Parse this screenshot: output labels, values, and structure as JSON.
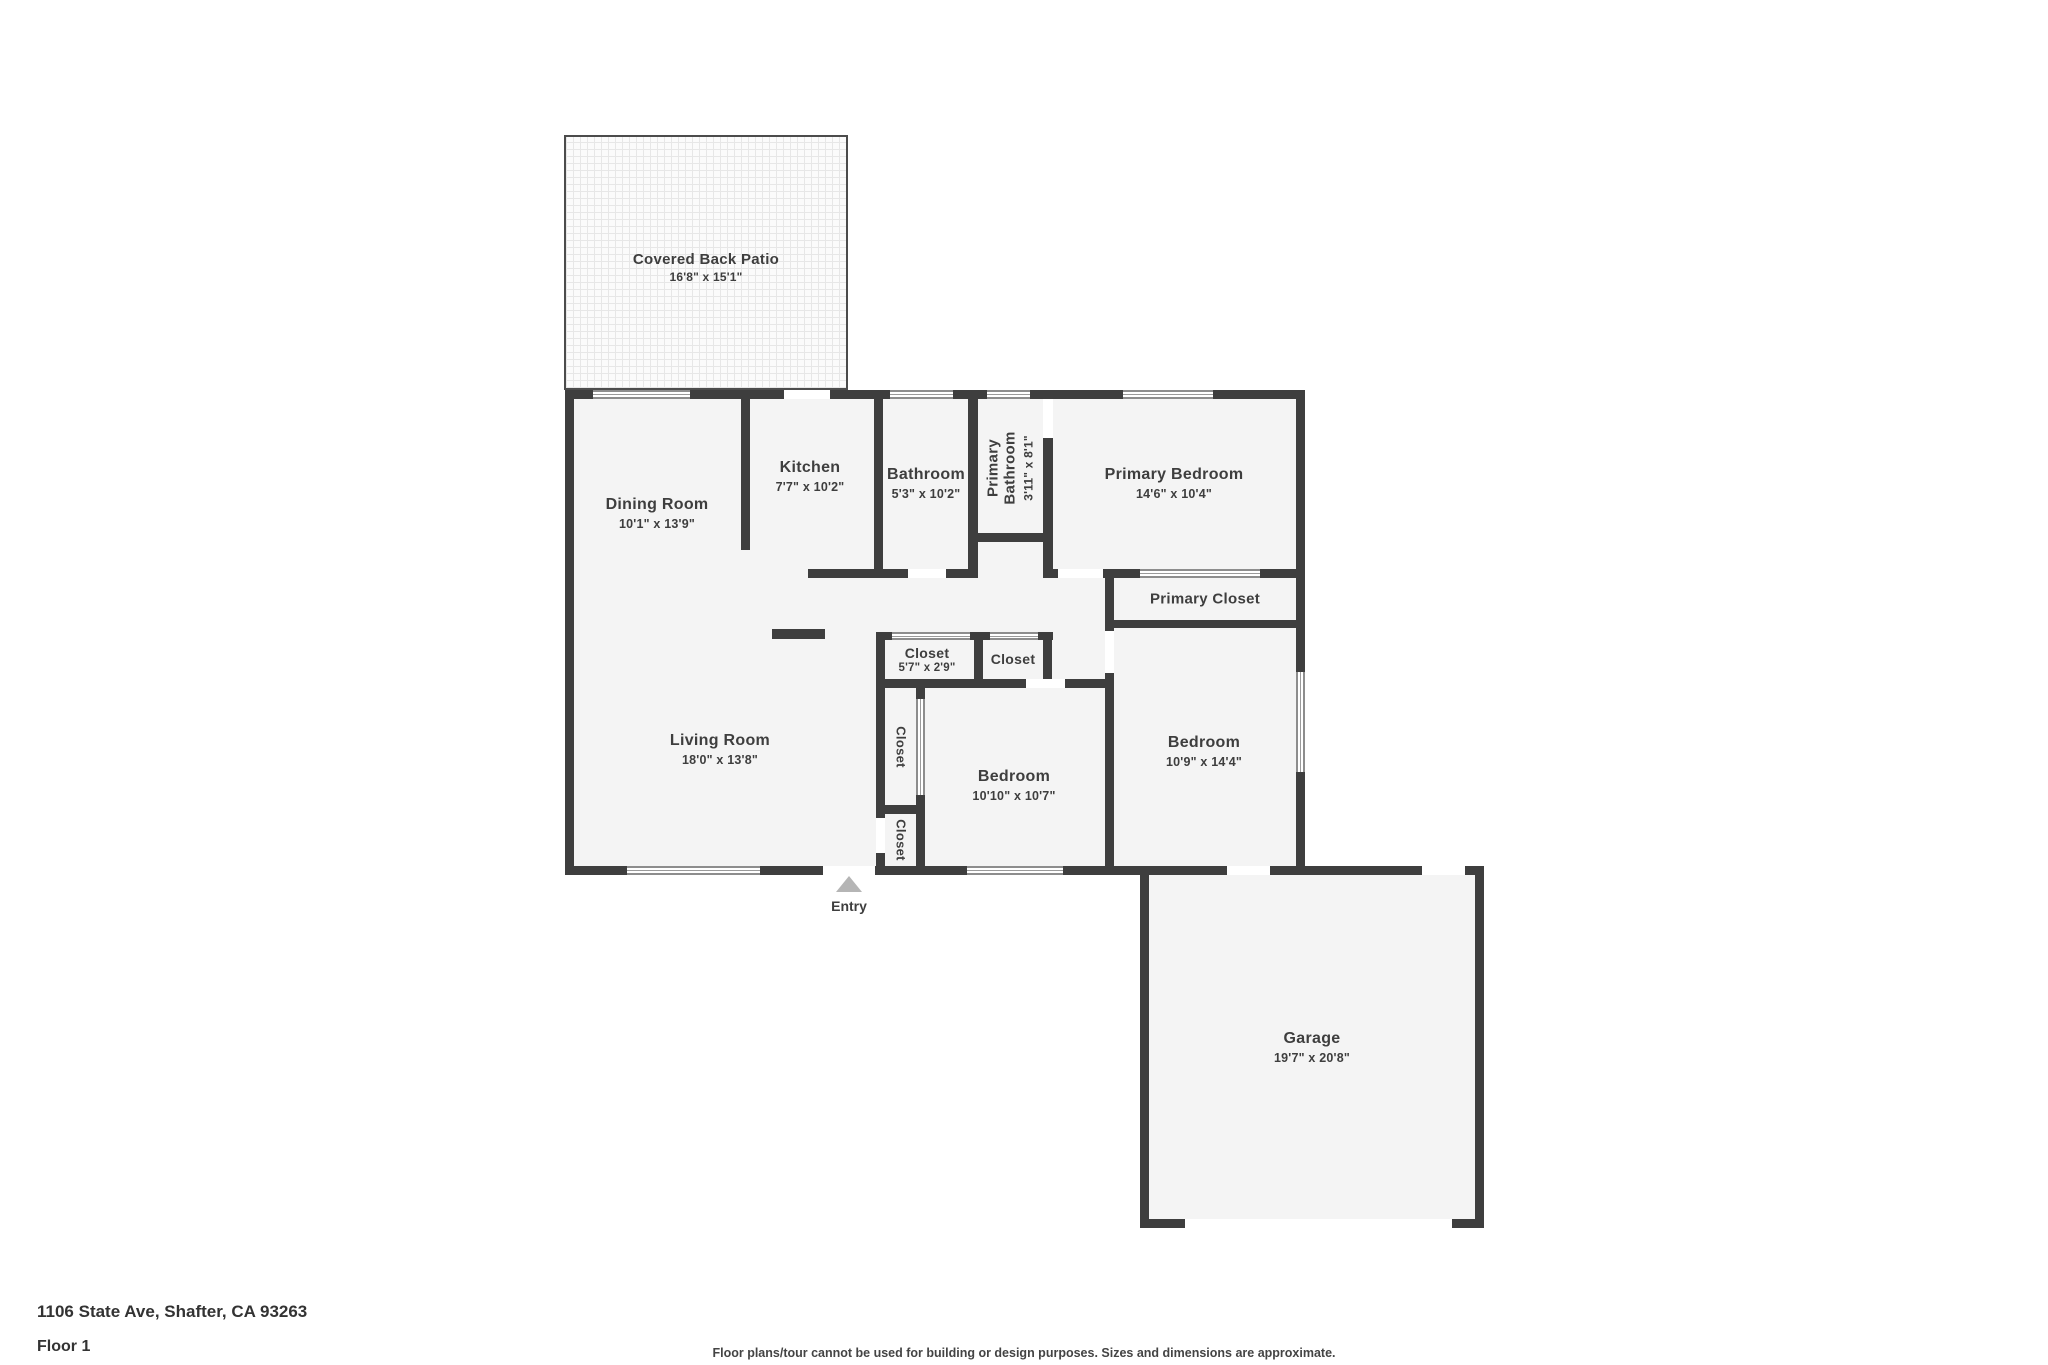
{
  "meta": {
    "address": "1106 State Ave, Shafter, CA 93263",
    "floor": "Floor 1",
    "disclaimer": "Floor plans/tour cannot be used for building or design purposes. Sizes and dimensions are approximate.",
    "entry_label": "Entry"
  },
  "colors": {
    "wall": "#3e3e3e",
    "room_fill": "#f4f4f4",
    "text": "#3e3e3e",
    "entry_arrow": "#b5b5b5"
  },
  "rooms": {
    "patio": {
      "name": "Covered Back Patio",
      "dims": "16'8\" x 15'1\""
    },
    "dining": {
      "name": "Dining Room",
      "dims": "10'1\" x 13'9\""
    },
    "kitchen": {
      "name": "Kitchen",
      "dims": "7'7\" x 10'2\""
    },
    "bathroom": {
      "name": "Bathroom",
      "dims": "5'3\" x 10'2\""
    },
    "primary_bathroom": {
      "name": "Primary Bathroom",
      "dims": "3'11\" x 8'1\""
    },
    "primary_bedroom": {
      "name": "Primary Bedroom",
      "dims": "14'6\" x 10'4\""
    },
    "primary_closet": {
      "name": "Primary Closet"
    },
    "closet_hall_a": {
      "name": "Closet",
      "dims": "5'7\" x 2'9\""
    },
    "closet_hall_b": {
      "name": "Closet"
    },
    "closet_tall": {
      "name": "Closet"
    },
    "closet_entry": {
      "name": "Closet"
    },
    "living": {
      "name": "Living Room",
      "dims": "18'0\" x 13'8\""
    },
    "bedroom_mid": {
      "name": "Bedroom",
      "dims": "10'10\" x 10'7\""
    },
    "bedroom_right": {
      "name": "Bedroom",
      "dims": "10'9\" x 14'4\""
    },
    "garage": {
      "name": "Garage",
      "dims": "19'7\" x 20'8\""
    }
  }
}
